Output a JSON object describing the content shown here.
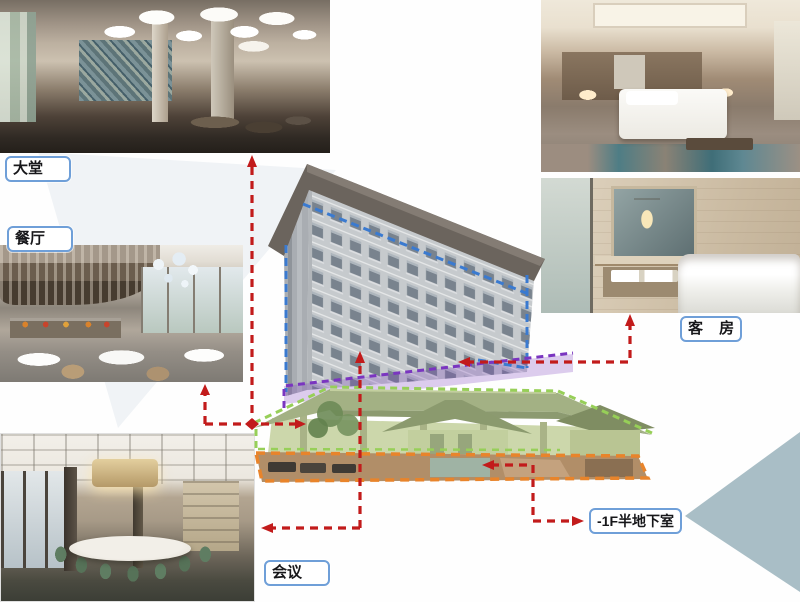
{
  "slide": {
    "title_hidden": "",
    "labels": {
      "lobby": "大堂",
      "restaurant": "餐厅",
      "conference": "会议",
      "guestroom": "客 房",
      "basement": "-1F半地下室"
    },
    "photos": {
      "lobby": "hotel-lobby-rendering",
      "restaurant": "restaurant-rendering",
      "conference": "conference-round-table-rendering",
      "bedroom": "guestroom-bedroom-rendering",
      "bathroom": "guestroom-bathroom-rendering"
    },
    "building": {
      "sections": [
        {
          "name": "tower-guestrooms",
          "outline_color_key": "blue"
        },
        {
          "name": "mid-function-band",
          "outline_color_key": "purple"
        },
        {
          "name": "podium",
          "outline_color_key": "green"
        },
        {
          "name": "semi-basement",
          "outline_color_key": "orange"
        }
      ]
    }
  },
  "colors": {
    "red": "#c21b1b",
    "blue": "#3a7ad0",
    "purple": "#7a35c0",
    "green": "#97cf58",
    "orange": "#e8842b",
    "labelborder": "#6f9fd8",
    "teal": "#a9bec6"
  }
}
